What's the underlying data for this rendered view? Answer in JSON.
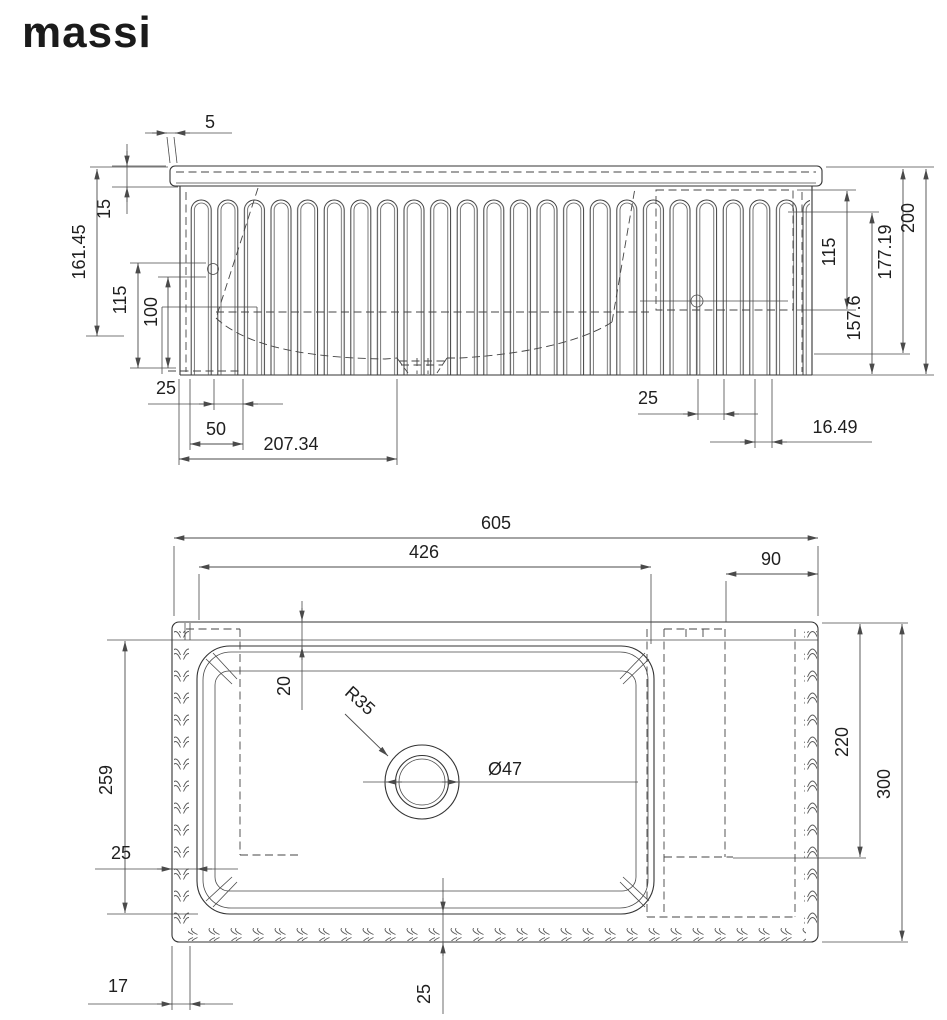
{
  "brand": {
    "logo_text": "massi"
  },
  "colors": {
    "line": "#333333",
    "dim": "#4a4a4a",
    "text": "#1f1f1f",
    "background": "#ffffff"
  },
  "front_view": {
    "label": "front elevation of fluted sink",
    "dims": {
      "rim_overhang": "5",
      "rim_height": "15",
      "height_to_hole": "161.45",
      "left_115": "115",
      "left_100": "100",
      "flute_pitch_25": "25",
      "flute_pitch_50": "50",
      "drain_offset": "207.34",
      "right_slot_25": "25",
      "right_slot_16": "16.49",
      "right_115": "115",
      "right_157": "157.6",
      "right_177": "177.19",
      "overall_height": "200"
    }
  },
  "plan_view": {
    "label": "top plan of fluted sink",
    "dims": {
      "overall_width": "605",
      "basin_width": "426",
      "shelf_width": "90",
      "rim_gap_20": "20",
      "drain_radius": "R35",
      "drain_diameter": "Ø47",
      "basin_depth_259": "259",
      "left_gap_25": "25",
      "shelf_depth_220": "220",
      "overall_depth": "300",
      "flute_width_17": "17",
      "bottom_gap_25": "25"
    }
  }
}
